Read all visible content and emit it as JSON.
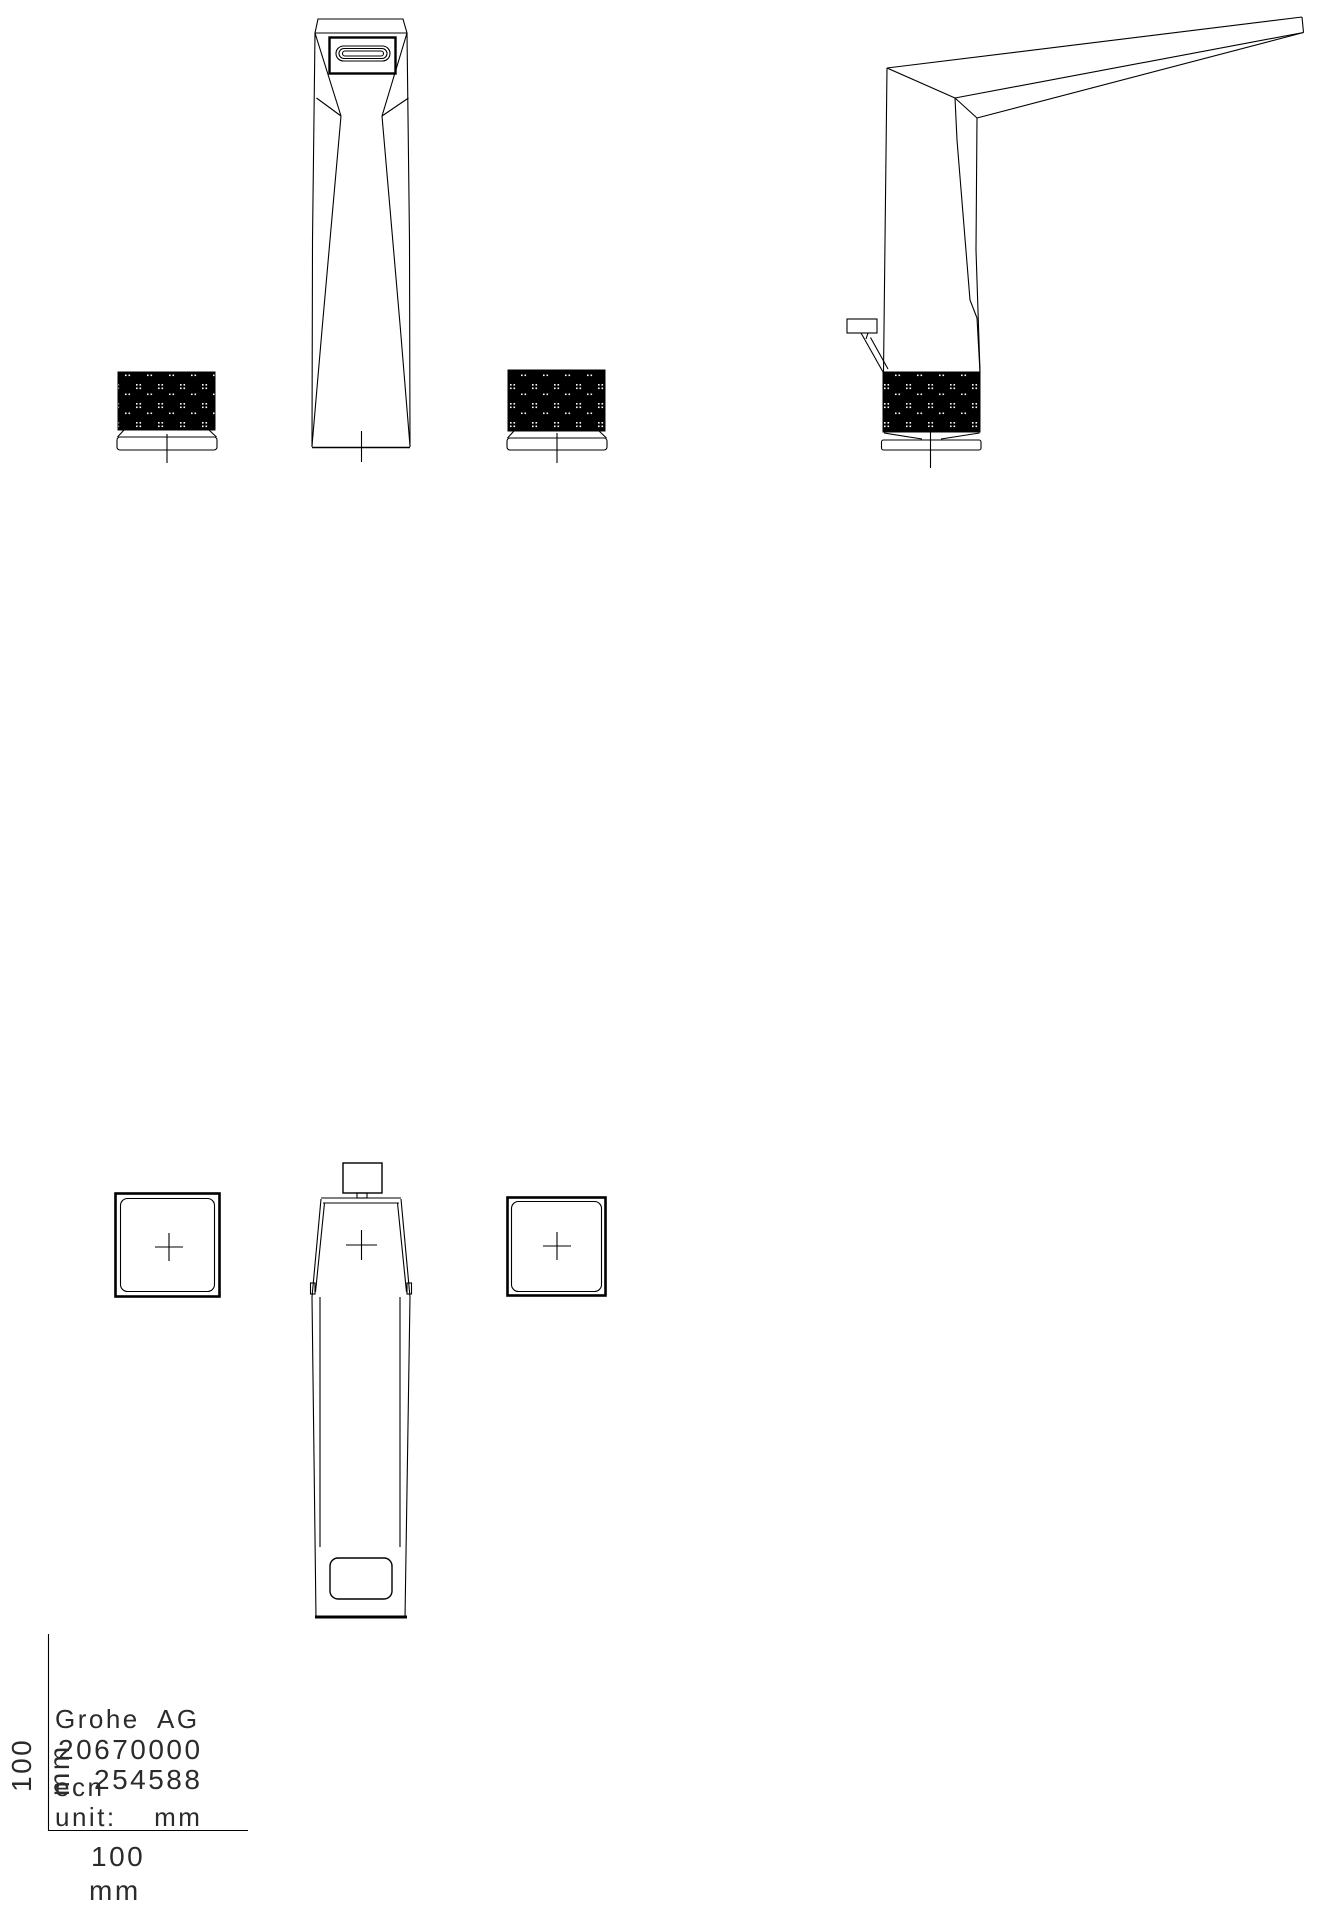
{
  "title_block": {
    "company": "Grohe AG",
    "part_number": "20670000",
    "ecn_label": "ecn",
    "ecn_number": "254588",
    "unit_note": "unit:  mm",
    "scale_x_value": "100",
    "scale_x_unit": "mm",
    "scale_y_value": "100",
    "scale_y_unit": "mm"
  }
}
